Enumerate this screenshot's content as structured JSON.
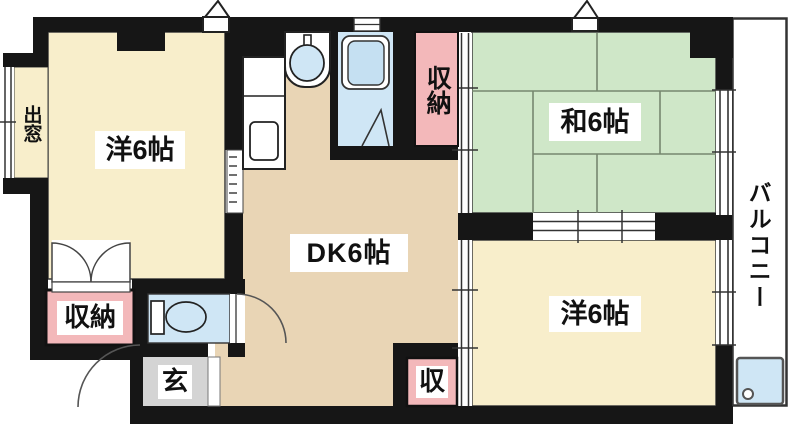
{
  "plan": {
    "type": "japanese-apartment-floor-plan",
    "labels": {
      "western_room_top": "洋6帖",
      "dining_kitchen": "DK6帖",
      "japanese_room": "和6帖",
      "western_room_bottom": "洋6帖",
      "closet_top": "収納",
      "closet_bottom_left": "収納",
      "closet_small": "収",
      "entrance": "玄",
      "bay_window": "出窓",
      "balcony": "バルコニー"
    },
    "colors": {
      "wall": "#161616",
      "cream": "#f8eecb",
      "tan": "#e9d5b5",
      "green": "#cfe7c8",
      "pink": "#f3b8ba",
      "gray": "#d4d4d4",
      "blue": "#cfe6f5",
      "bluedeep": "#c5e0f2",
      "tatamiline": "#76876f",
      "outline": "#3d3d3d",
      "arc": "#555555",
      "white": "#ffffff"
    }
  }
}
